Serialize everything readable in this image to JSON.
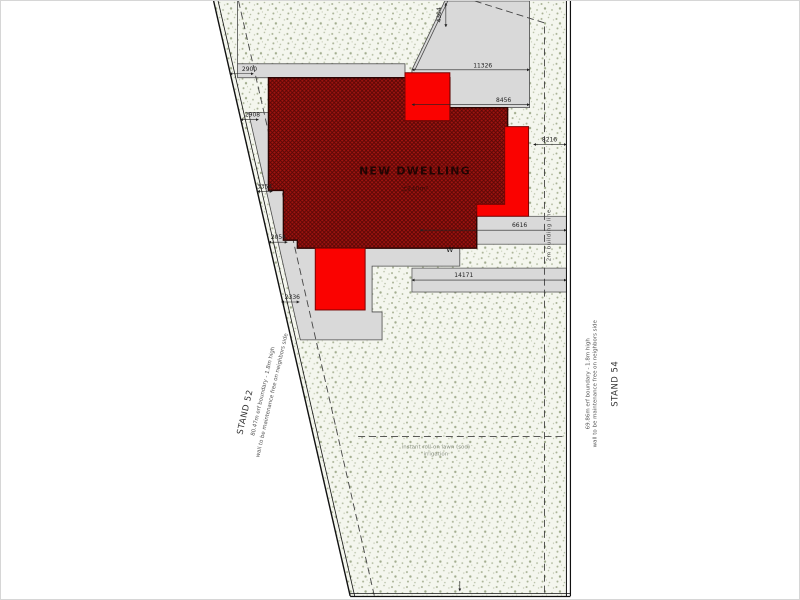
{
  "plan": {
    "dwelling": {
      "label": "NEW DWELLING",
      "area": "±240m²",
      "window_mark": "W"
    },
    "stands": {
      "left": "STAND 52",
      "right": "STAND 54"
    },
    "boundaries": {
      "left_line1": "80.47m erf boundary - 1.8m high",
      "left_line2": "wall to be maintenance free on neighbors side",
      "right_line1": "69.86m erf boundary - 1.8m high",
      "right_line2": "wall to be maintenance free on neighbors side"
    },
    "building_line_label": "2m building line",
    "yard_note": {
      "line1": "instant roll-on lawn (sod)",
      "line2": "irrigation"
    },
    "dims": {
      "d2900": "2900",
      "d2908": "2908",
      "d3354": "3354",
      "d2054": "2054",
      "d2336": "2336",
      "d4304": "4304",
      "d11326": "11326",
      "d8456": "8456",
      "d8216": "8216",
      "d6616": "6616",
      "d14171": "14171"
    },
    "colors": {
      "new_work_red": "#fa0200",
      "dwelling_fill": "#a01310",
      "terrace_gray": "#d9d9d9"
    }
  }
}
